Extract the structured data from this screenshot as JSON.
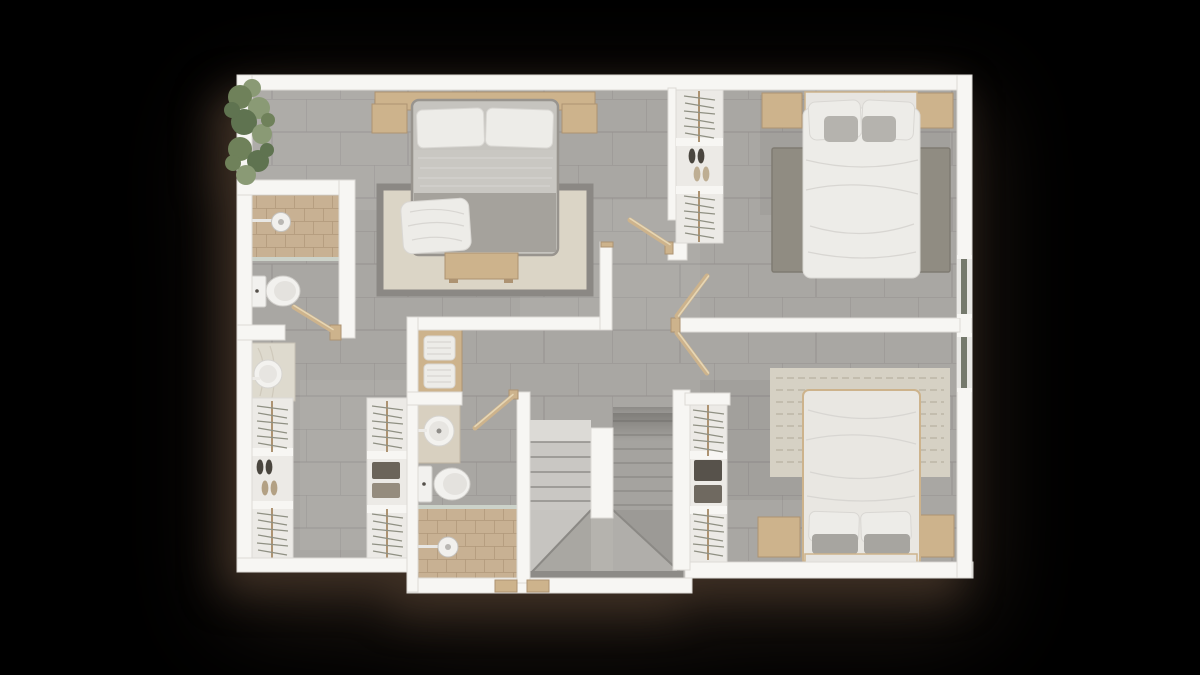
{
  "scene": {
    "kind": "architectural-floor-plan-top-view-render",
    "floor": "upper-floor",
    "background": "#000000",
    "shadow-color": "#42342a",
    "visible_text": []
  },
  "palette": {
    "background": "#000000",
    "wall": "#f7f6f3",
    "wall-edge": "#dcdad6",
    "floor-tile": "#a9a7a3",
    "floor-line": "#96948f",
    "shower-tile": "#c8b193",
    "shower-line": "#b29a7b",
    "closet-floor": "#eceae6",
    "wood": "#cdb38c",
    "wood-dark": "#ad9372",
    "wood-light": "#e6d6b4",
    "porcelain": "#f2f1ee",
    "glass": "#ccd2c9",
    "linen": "#edece8",
    "blanket-gray": "#c9c7c2",
    "duvet-dark": "#a5a29c",
    "rug-master-field": "#dbd5c6",
    "rug-master-border": "#8b8884",
    "rug-bed2": "#908c82",
    "rug-bed3": "#d6d1c4",
    "stair-light": "#c9c7c3",
    "stair-lighter": "#dcdad6",
    "stair-dark": "#a5a39f",
    "step-line": "#8f8d89",
    "hanger": "#8f9083",
    "plant-green-1": "#6f815a",
    "plant-green-2": "#8a9a75",
    "plant-green-3": "#5f7350"
  },
  "rooms": [
    {
      "id": "master-bedroom",
      "position": "top-left",
      "furniture": [
        "double-bed",
        "two-pillows",
        "gray-blanket",
        "white-throw",
        "headboard-shelf",
        "nightstand-left",
        "nightstand-right",
        "area-rug-bordered",
        "foot-bench",
        "planter-row"
      ]
    },
    {
      "id": "master-bathroom",
      "position": "left",
      "furniture": [
        "walk-in-shower",
        "shower-head",
        "glass-screen",
        "toilet",
        "swing-door"
      ]
    },
    {
      "id": "master-closet-hall",
      "position": "bottom-left",
      "furniture": [
        "vessel-sink-vanity",
        "wardrobe-left-hangers",
        "wardrobe-left-shoes",
        "wardrobe-right-hangers",
        "wardrobe-right-folded-clothes"
      ]
    },
    {
      "id": "hall-landing",
      "position": "center",
      "furniture": [
        "towel-shelf",
        "doorways"
      ]
    },
    {
      "id": "bathroom-2",
      "position": "center",
      "furniture": [
        "vessel-sink-vanity",
        "toilet",
        "glass-screen",
        "walk-in-shower",
        "shower-head",
        "swing-door"
      ]
    },
    {
      "id": "staircase",
      "position": "center-bottom",
      "furniture": [
        "up-flight",
        "down-flight",
        "winder-steps",
        "divider-wall",
        "two-thresholds"
      ]
    },
    {
      "id": "bedroom-2",
      "position": "top-right",
      "furniture": [
        "double-bed",
        "four-pillows",
        "nightstand-left",
        "nightstand-right",
        "area-rug",
        "open-wardrobe-hangers-shoes",
        "window-east"
      ]
    },
    {
      "id": "bedroom-3",
      "position": "bottom-right",
      "furniture": [
        "double-bed",
        "four-pillows",
        "nightstand-left",
        "nightstand-right",
        "wavy-area-rug",
        "open-wardrobe-hangers-clothes",
        "window-east"
      ]
    }
  ]
}
